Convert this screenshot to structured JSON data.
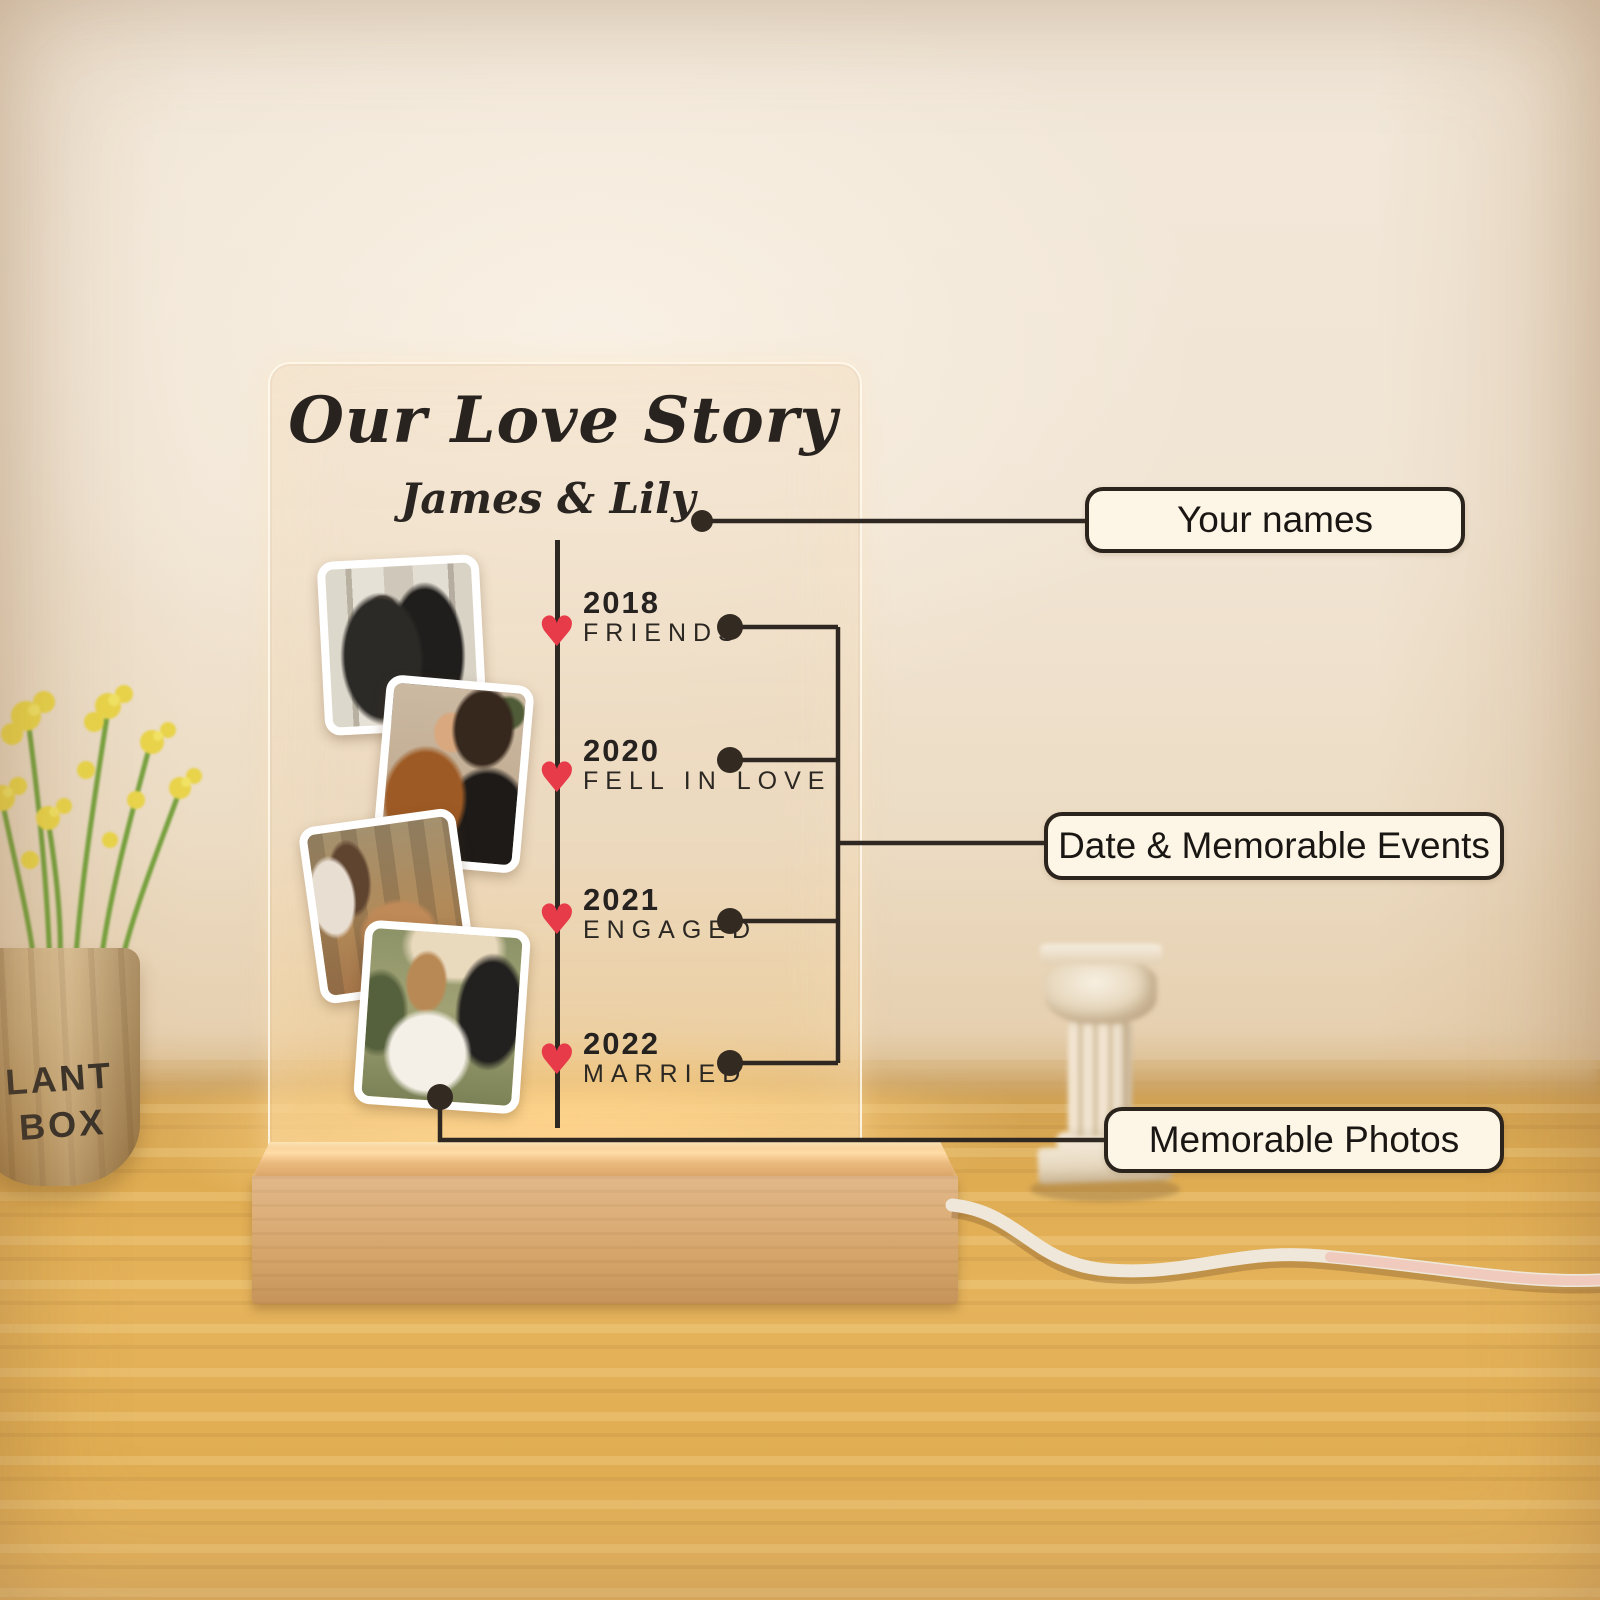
{
  "scene": {
    "description": "Product photo of a personalized acrylic LED night light on a wooden base, standing on a wooden table, annotated with feature callouts"
  },
  "plaque": {
    "title": "Our Love Story",
    "names": "James & Lily",
    "timeline": [
      {
        "year": "2018",
        "event": "FRIENDS"
      },
      {
        "year": "2020",
        "event": "FELL IN LOVE"
      },
      {
        "year": "2021",
        "event": "ENGAGED"
      },
      {
        "year": "2022",
        "event": "MARRIED"
      }
    ]
  },
  "callouts": [
    {
      "label": "Your names"
    },
    {
      "label": "Date & Memorable Events"
    },
    {
      "label": "Memorable Photos"
    }
  ],
  "props": {
    "plant_pot_text_line1": "LANT",
    "plant_pot_text_line2": "BOX"
  },
  "icons": {
    "heart": "♥"
  },
  "colors": {
    "heart_red": "#e83b49",
    "connector_line": "#2f2822",
    "callout_fill": "#fdf5e6",
    "callout_border": "#2b241d",
    "lamp_glow": "#f5c37a",
    "wood_base": "#dcae78",
    "table_wood": "#e0ad52",
    "wall": "#f1e5d4"
  }
}
